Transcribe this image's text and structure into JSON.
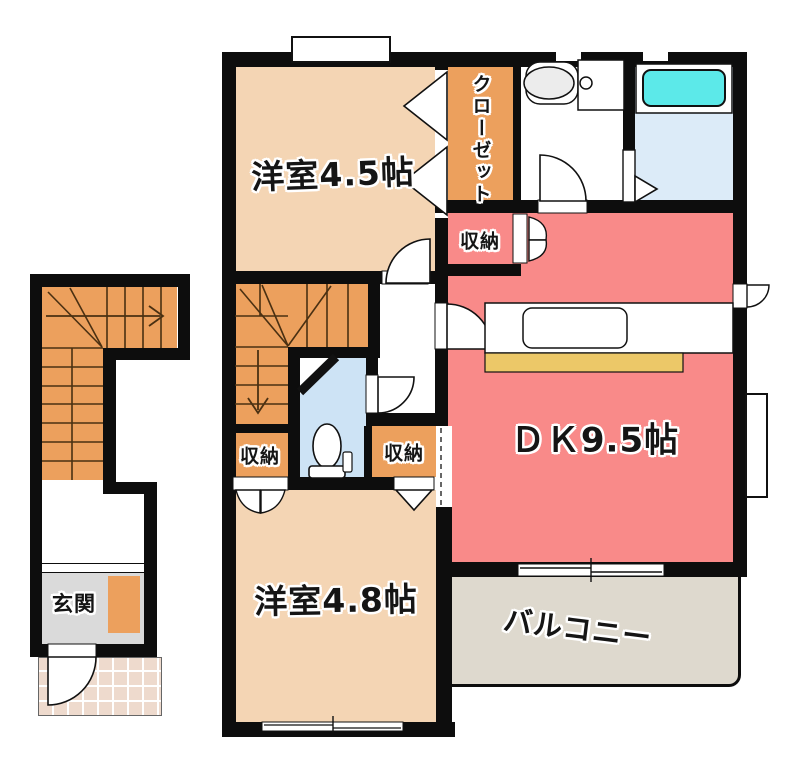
{
  "floorplan": {
    "labels": {
      "western_room_a": "洋室4.5帖",
      "western_room_b": "洋室4.8帖",
      "dining_kitchen": "ＤＫ9.5帖",
      "closet": "クローゼット",
      "storage_top": "収納",
      "storage_left": "収納",
      "storage_right": "収納",
      "balcony": "バルコニー",
      "entrance": "玄関"
    },
    "colors": {
      "wall": "#0d0d0d",
      "room_peach": "#f4d5b4",
      "accent_orange": "#eca05d",
      "dk_pink": "#f98a89",
      "bath_floor": "#dcebf8",
      "toilet_floor": "#cde3f5",
      "tub_cyan": "#5ce9e9",
      "counter_yellow": "#ecc868",
      "entrance_gray": "#dadada",
      "balcony_gray": "#ded9ce",
      "porch_tile": "#eedacd",
      "stair_line": "#4a3012"
    }
  }
}
